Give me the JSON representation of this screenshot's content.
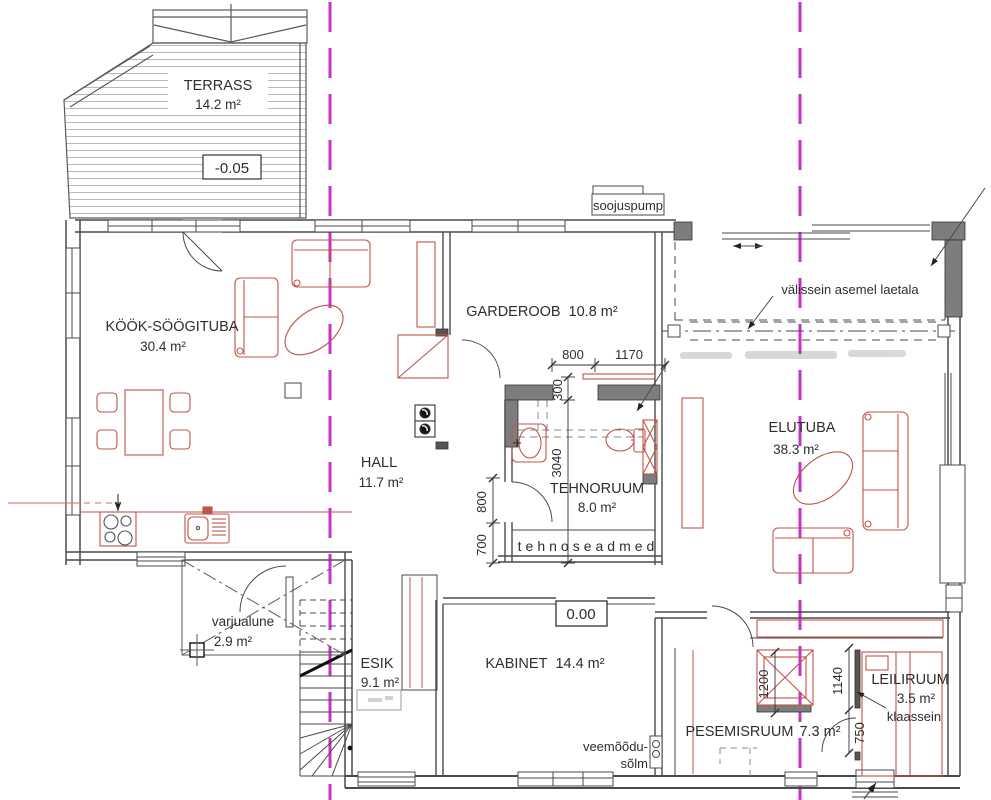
{
  "plan": {
    "rooms": {
      "terrass": {
        "name": "TERRASS",
        "area": "14.2 m²"
      },
      "kook": {
        "name": "KÖÖK-SÖÖGITUBA",
        "area": "30.4 m²"
      },
      "garderoob": {
        "name": "GARDEROOB",
        "area": "10.8 m²"
      },
      "hall": {
        "name": "HALL",
        "area": "11.7 m²"
      },
      "tehnoruum": {
        "name": "TEHNORUUM",
        "area": "8.0 m²"
      },
      "elutuba": {
        "name": "ELUTUBA",
        "area": "38.3 m²"
      },
      "esik": {
        "name": "ESIK",
        "area": "9.1 m²"
      },
      "kabinet": {
        "name": "KABINET",
        "area": "14.4 m²"
      },
      "pesemisruum": {
        "name": "PESEMISRUUM",
        "area": "7.3 m²"
      },
      "leiliruum": {
        "name": "LEILIRUUM",
        "area": "3.5 m²"
      },
      "varjualune": {
        "name": "varjualune",
        "area": "2.9 m²"
      }
    },
    "annotations": {
      "soojuspump": "soojuspump",
      "valissein": "välissein asemel laetala",
      "tehnoseadmed": "tehnoseadmed",
      "veemoodu_line1": "veemõõdu-",
      "veemoodu_line2": "sõlm",
      "klaassein": "klaassein"
    },
    "elevations": {
      "terrace": "-0.05",
      "floor": "0.00"
    },
    "dimensions": {
      "d800h": "800",
      "d1170": "1170",
      "d300": "300",
      "d3040": "3040",
      "d800v": "800",
      "d700": "700",
      "d1200": "1200",
      "d1140": "1140",
      "d750": "750"
    },
    "colors": {
      "furniture_red": "#bf5449",
      "axis_magenta": "#c832c8",
      "wall_dark_fill": "#7d7d7d",
      "line_black": "#4a4a4a"
    }
  }
}
